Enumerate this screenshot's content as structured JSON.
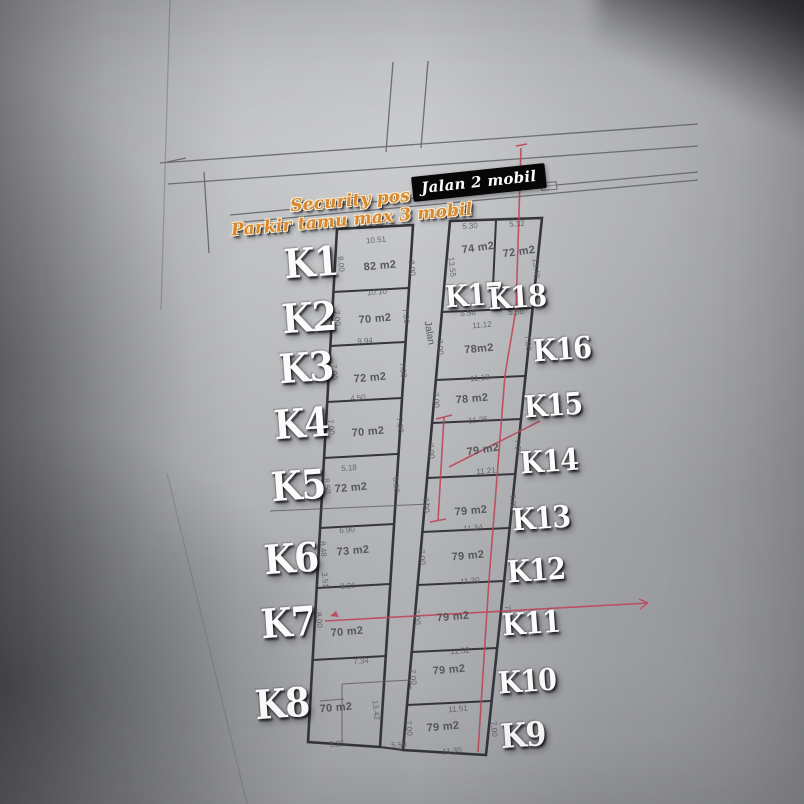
{
  "scene": {
    "top_road_sign": "Jalan 2 mobil",
    "security_note_line1": "Security pos",
    "security_note_line2": "Parkir tamu max 3 mobil",
    "center_road_label": "Jalan",
    "road_bottom_dim": "5.50"
  },
  "colors": {
    "annotation_red": "#bf4458",
    "sign_background": "#070708",
    "security_text": "#d8892f",
    "plan_line": "#35363b"
  },
  "plots": {
    "k1": {
      "label": "K1",
      "area": "82 m2",
      "dim_top": "10.51",
      "dim_bottom": "10.10",
      "dim_left": "8.00",
      "dim_right": "8.00"
    },
    "k2": {
      "label": "K2",
      "area": "70 m2",
      "dim_bottom": "9.94",
      "dim_left": "7.00",
      "dim_right": "7.00"
    },
    "k3": {
      "label": "K3",
      "area": "72 m2",
      "dim_bottom": "4.50",
      "dim_left": "7.00",
      "dim_right": "7.30"
    },
    "k4": {
      "label": "K4",
      "area": "70 m2",
      "dim_bottom": "5.18",
      "dim_left": "7.00",
      "dim_right": "7.30"
    },
    "k5": {
      "label": "K5",
      "area": "72 m2",
      "dim_bottom": "6.90",
      "dim_left": "8.50",
      "dim_right": "8.50"
    },
    "k6": {
      "label": "K6",
      "area": "73 m2",
      "dim_bottom": "8.26",
      "dim_left": "8.48",
      "dim_left2": "3.51"
    },
    "k7": {
      "label": "K7",
      "area": "70 m2",
      "dim_bottom": "7.34",
      "dim_left": "8.00"
    },
    "k8": {
      "label": "K8",
      "area": "70 m2",
      "dim_bottom": "5.25",
      "dim_right": "13.42"
    },
    "k9": {
      "label": "K9",
      "area": "79 m2",
      "dim_top": "11.51",
      "dim_bottom": "11.30",
      "dim_left": "7.00",
      "dim_right": "7.00"
    },
    "k10": {
      "label": "K10",
      "area": "79 m2",
      "dim_top": "11.32",
      "dim_left": "7.00"
    },
    "k11": {
      "label": "K11",
      "area": "79 m2",
      "dim_bottom": "11.32",
      "dim_left": "7.00",
      "dim_right": "7.30"
    },
    "k12": {
      "label": "K12",
      "area": "79 m2",
      "dim_bottom": "11.30",
      "dim_left": "7.00"
    },
    "k13": {
      "label": "K13",
      "area": "79 m2",
      "dim_bottom": "11.34",
      "dim_left": "7.00",
      "dim_right": "7.00"
    },
    "k14": {
      "label": "K14",
      "area": "79 m2",
      "dim_bottom": "11.21",
      "dim_left": "7.00",
      "dim_right": "7.00"
    },
    "k15": {
      "label": "K15",
      "area": "78 m2",
      "dim_top": "11.19",
      "dim_bottom": "11.25",
      "dim_left": "7.00"
    },
    "k16": {
      "label": "K16",
      "area": "78m2",
      "dim_top": "11.12",
      "dim_left": "7.00",
      "dim_right": "7.00"
    },
    "k17": {
      "label": "K17",
      "area": "74 m2",
      "dim_top": "5.30",
      "dim_bottom": "5.56",
      "dim_left": "13.55"
    },
    "k18": {
      "label": "K18",
      "area": "72 m2",
      "dim_top": "5.32",
      "dim_bottom": "5.56",
      "dim_right": "13.40"
    }
  }
}
